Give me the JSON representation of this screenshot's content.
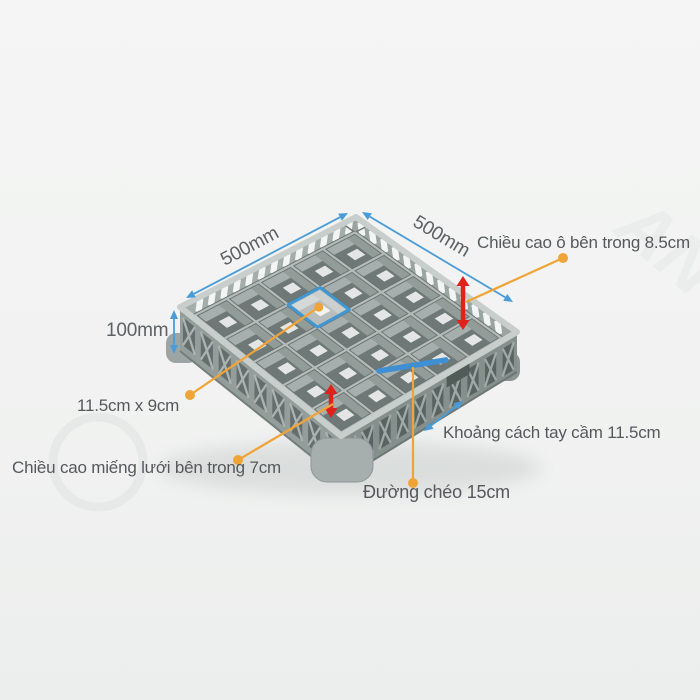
{
  "product": {
    "type": "dishwasher-glass-rack-25-compartments",
    "grid_rows": 5,
    "grid_cols": 5
  },
  "labels": {
    "width_left": "500mm",
    "width_right": "500mm",
    "height": "100mm",
    "cell_inner_height": "Chiều cao ô bên trong 8.5cm",
    "cell_size": "11.5cm x 9cm",
    "handle_gap": "Khoảng cách tay cầm 11.5cm",
    "mesh_inner_height": "Chiều cao miếng lưới bên trong 7cm",
    "diagonal": "Đường chéo 15cm"
  },
  "watermark": {
    "glyphs": "AN"
  },
  "colors": {
    "dimension_blue": "#4a9cd9",
    "diagonal_blue": "#3e8fd4",
    "marker_red": "#e1211c",
    "leader_orange": "#f0a437",
    "highlight_blue": "#3f97d3",
    "rack_gray": "#9aa4a2",
    "background": "#f1f2f1",
    "label_text": "#55595c"
  }
}
